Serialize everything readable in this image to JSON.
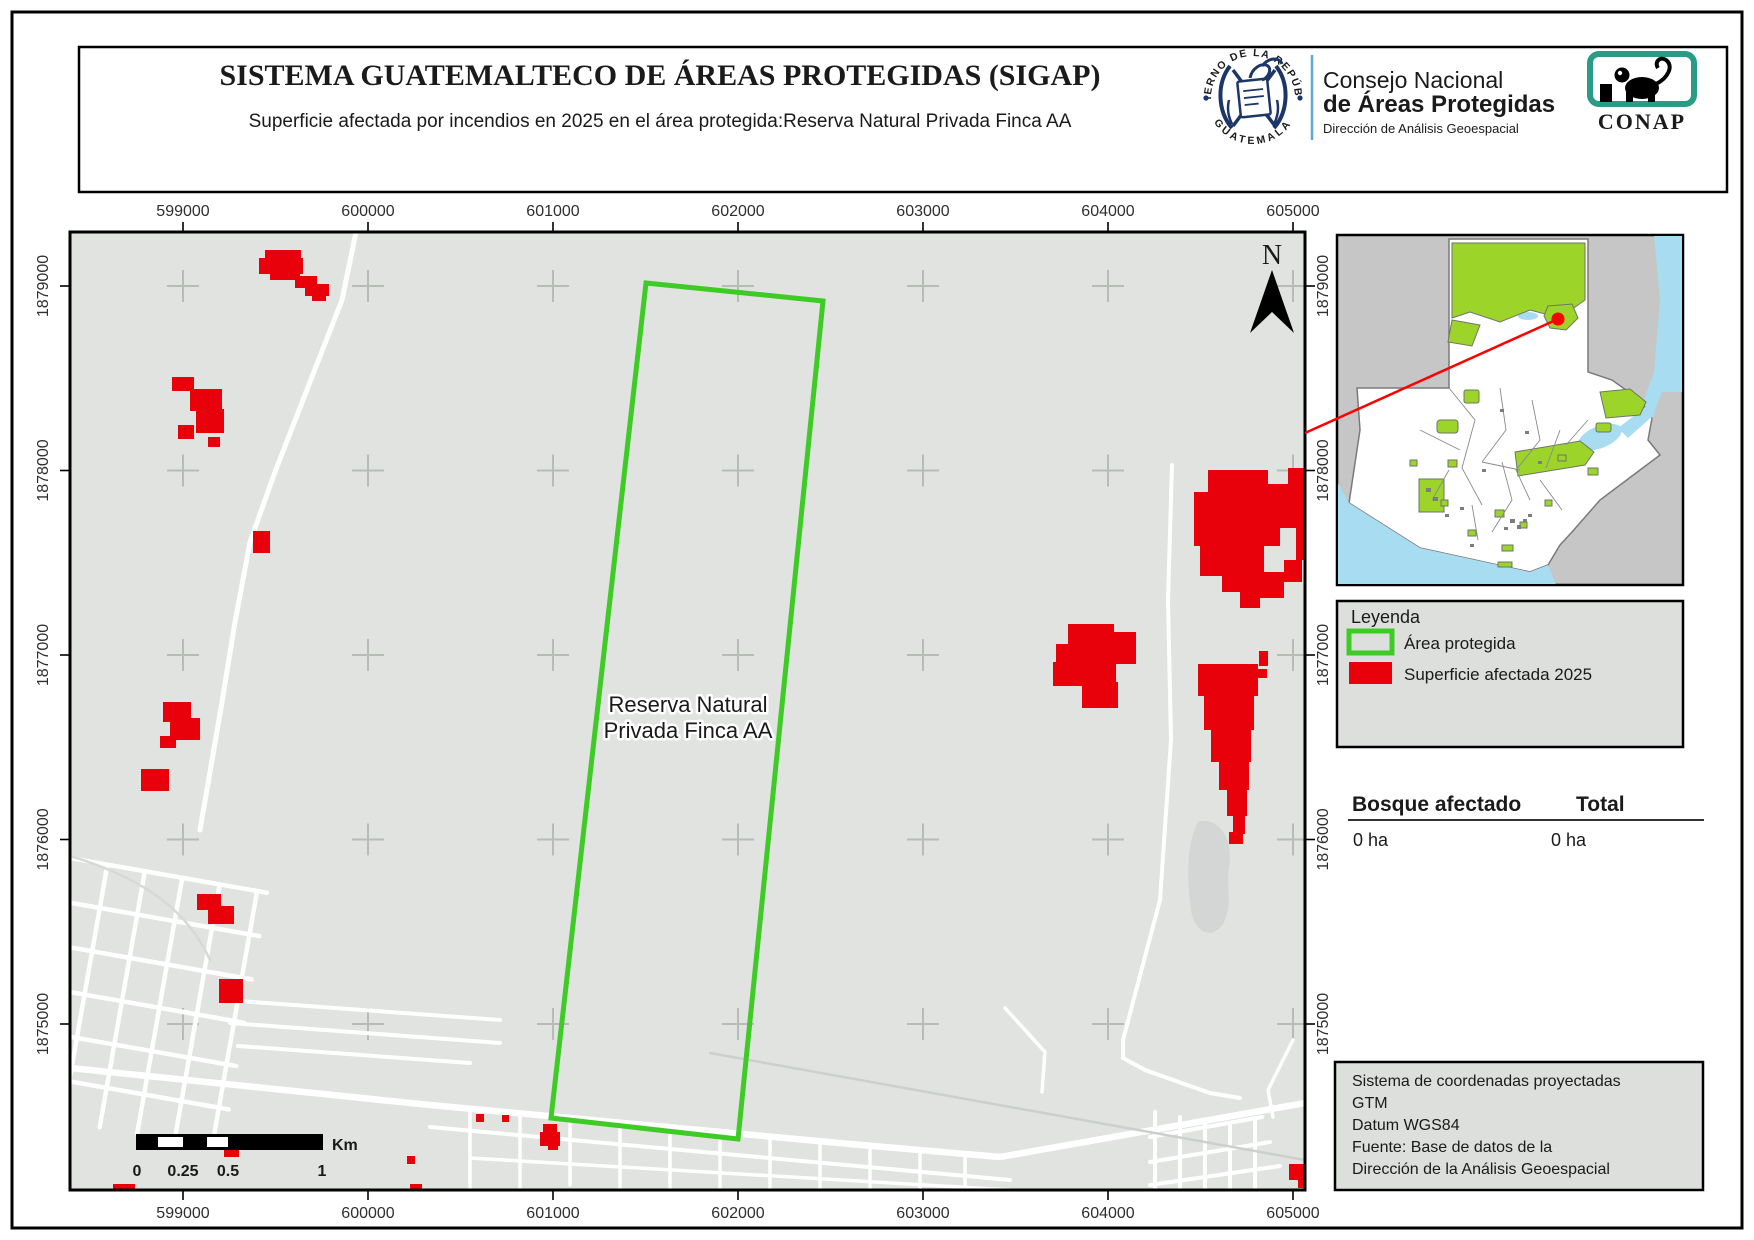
{
  "header": {
    "title": "SISTEMA GUATEMALTECO DE ÁREAS PROTEGIDAS  (SIGAP)",
    "subtitle": "Superficie afectada por incendios en 2025 en el área protegida:Reserva Natural Privada Finca AA",
    "gov_logo": {
      "arc_top": "GOBIERNO DE LA REPÚBLICA",
      "arc_bottom": "GUATEMALA"
    },
    "org": {
      "line1": "Consejo Nacional",
      "line2": "de Áreas Protegidas",
      "line3": "Dirección de Análisis Geoespacial"
    },
    "conap_label": "CONAP"
  },
  "map": {
    "area_label_line1": "Reserva Natural",
    "area_label_line2": "Privada Finca AA",
    "north_label": "N",
    "x_ticks": [
      "599000",
      "600000",
      "601000",
      "602000",
      "603000",
      "604000",
      "605000"
    ],
    "y_ticks": [
      "1879000",
      "1878000",
      "1877000",
      "1876000",
      "1875000"
    ],
    "scale_bar": {
      "labels": [
        "0",
        "0.25",
        "0.5",
        "1"
      ],
      "unit": "Km"
    }
  },
  "legend": {
    "title": "Leyenda",
    "items": [
      {
        "label": "Área protegida",
        "type": "outline",
        "color": "#3ecb25"
      },
      {
        "label": "Superficie afectada 2025",
        "type": "fill",
        "color": "#e8000b"
      }
    ]
  },
  "stats": {
    "col1_header": "Bosque afectado",
    "col2_header": "Total",
    "col1_value": "0 ha",
    "col2_value": "0 ha"
  },
  "info_box": {
    "lines": [
      "Sistema de coordenadas proyectadas",
      "GTM",
      "Datum WGS84",
      "Fuente: Base de datos de la",
      "Dirección de la Análisis Geoespacial"
    ]
  },
  "colors": {
    "map_bg": "#e0e3e0",
    "fire": "#e8000b",
    "protected_outline": "#3ecb25",
    "inset_protected": "#9cd42a",
    "inset_water": "#a8dcf0",
    "inset_neighbors": "#c6c6c6",
    "panel_bg": "#dcdfdc",
    "navy": "#1c3667",
    "steel_blue": "#3f5277",
    "light_blue": "#3f9bd8",
    "conap_green": "#2a9b85"
  }
}
